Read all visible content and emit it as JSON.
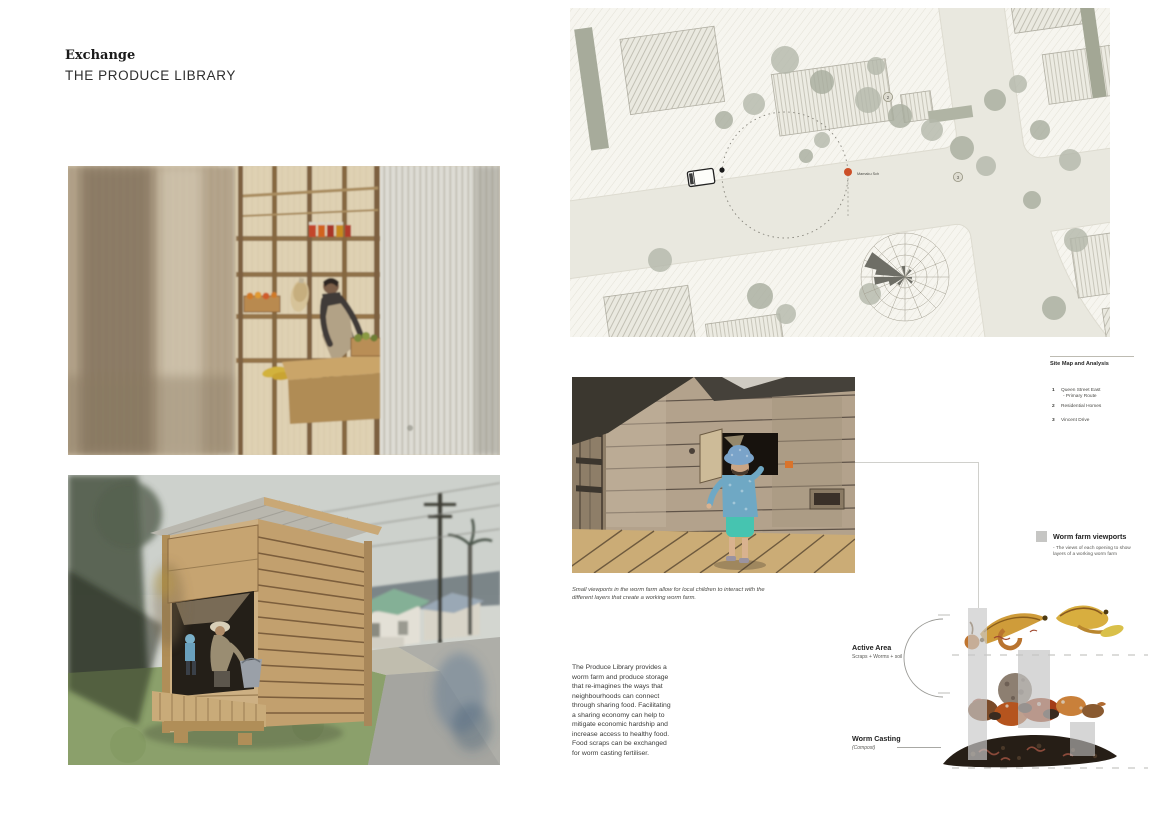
{
  "header": {
    "title": "Exchange",
    "subtitle": "THE PRODUCE LIBRARY"
  },
  "site_map": {
    "heading": "Site Map and Analysis",
    "legend": [
      {
        "num": "1",
        "label": "Queen Street East",
        "sub": "- Primary Route"
      },
      {
        "num": "2",
        "label": "Residential Homes",
        "sub": ""
      },
      {
        "num": "3",
        "label": "Vincent Drive",
        "sub": ""
      }
    ],
    "site_marker_label": "Mamaku Sch",
    "marker_2": "2",
    "marker_3": "3"
  },
  "viewport_figure": {
    "caption": "Small viewports in the worm farm allow for local children to interact with the different layers that create a working worm farm."
  },
  "description": "The Produce Library provides a worm farm and produce storage that re-imagines the ways that neighbourhoods can connect through sharing food. Facilitating a sharing economy can help to mitigate economic hardship and increase access to healthy food. Food scraps can be exchanged for worm casting fertiliser.",
  "worm_diagram": {
    "viewports_label": "Worm farm viewports",
    "viewports_note": "- The views of each opening to show layers of a working worm farm",
    "active_area_label": "Active Area",
    "active_area_sub": "Scraps + Worms + soil",
    "worm_casting_label": "Worm Casting",
    "worm_casting_sub": "(Compost)"
  },
  "colors": {
    "accent_red": "#cc4f28",
    "viewport_bar_gray": "#c8c8c8",
    "map_background": "#e9e8df"
  }
}
